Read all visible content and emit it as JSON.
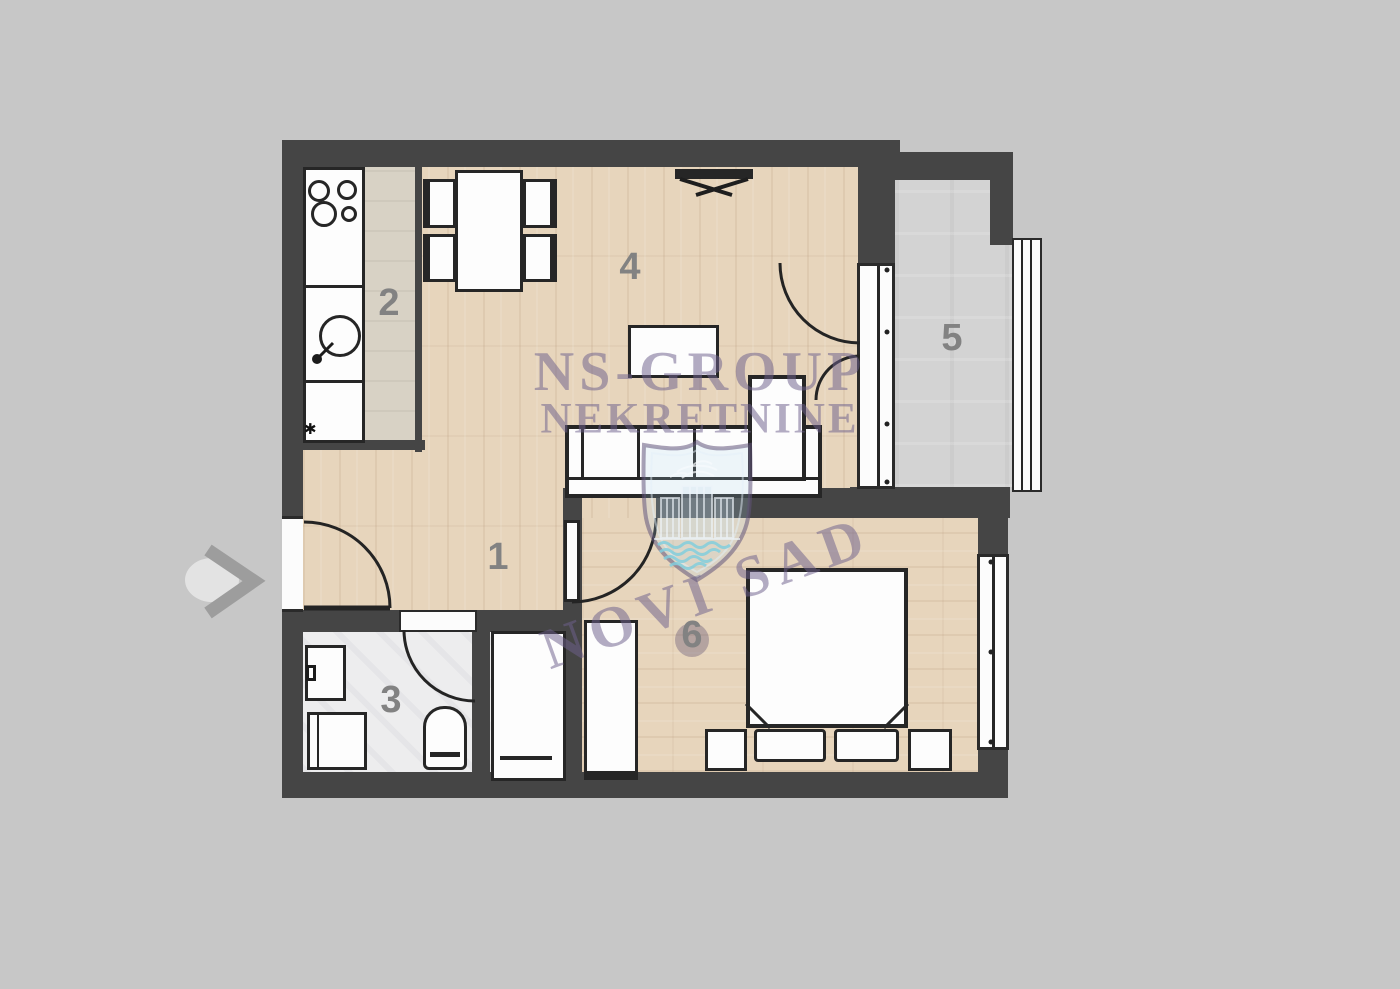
{
  "title": "apartment-floor-plan",
  "rooms": {
    "hall": "1",
    "kitchen": "2",
    "bathroom": "3",
    "living": "4",
    "terrace": "5",
    "bedroom": "6"
  },
  "watermark": {
    "line1": "NS-GROUP",
    "line2": "NEKRETNINE",
    "line3": "NOVI SAD"
  },
  "symbols": {
    "kitchen_asterisk": "✱",
    "entrance_arrow_icon": "chevron-right",
    "crest_icon": "novi-sad-coat-of-arms"
  },
  "colors": {
    "background": "#c7c7c7",
    "wall": "#454545",
    "line": "#262626",
    "wood": "#e7d5bc",
    "tile": "#d8d2c5",
    "bath": "#ededee",
    "terrace": "#d3d3d3",
    "label": "#828282",
    "watermark_purple": "rgba(110,96,140,0.52)",
    "watermark_blue": "rgba(120,205,225,0.85)"
  }
}
